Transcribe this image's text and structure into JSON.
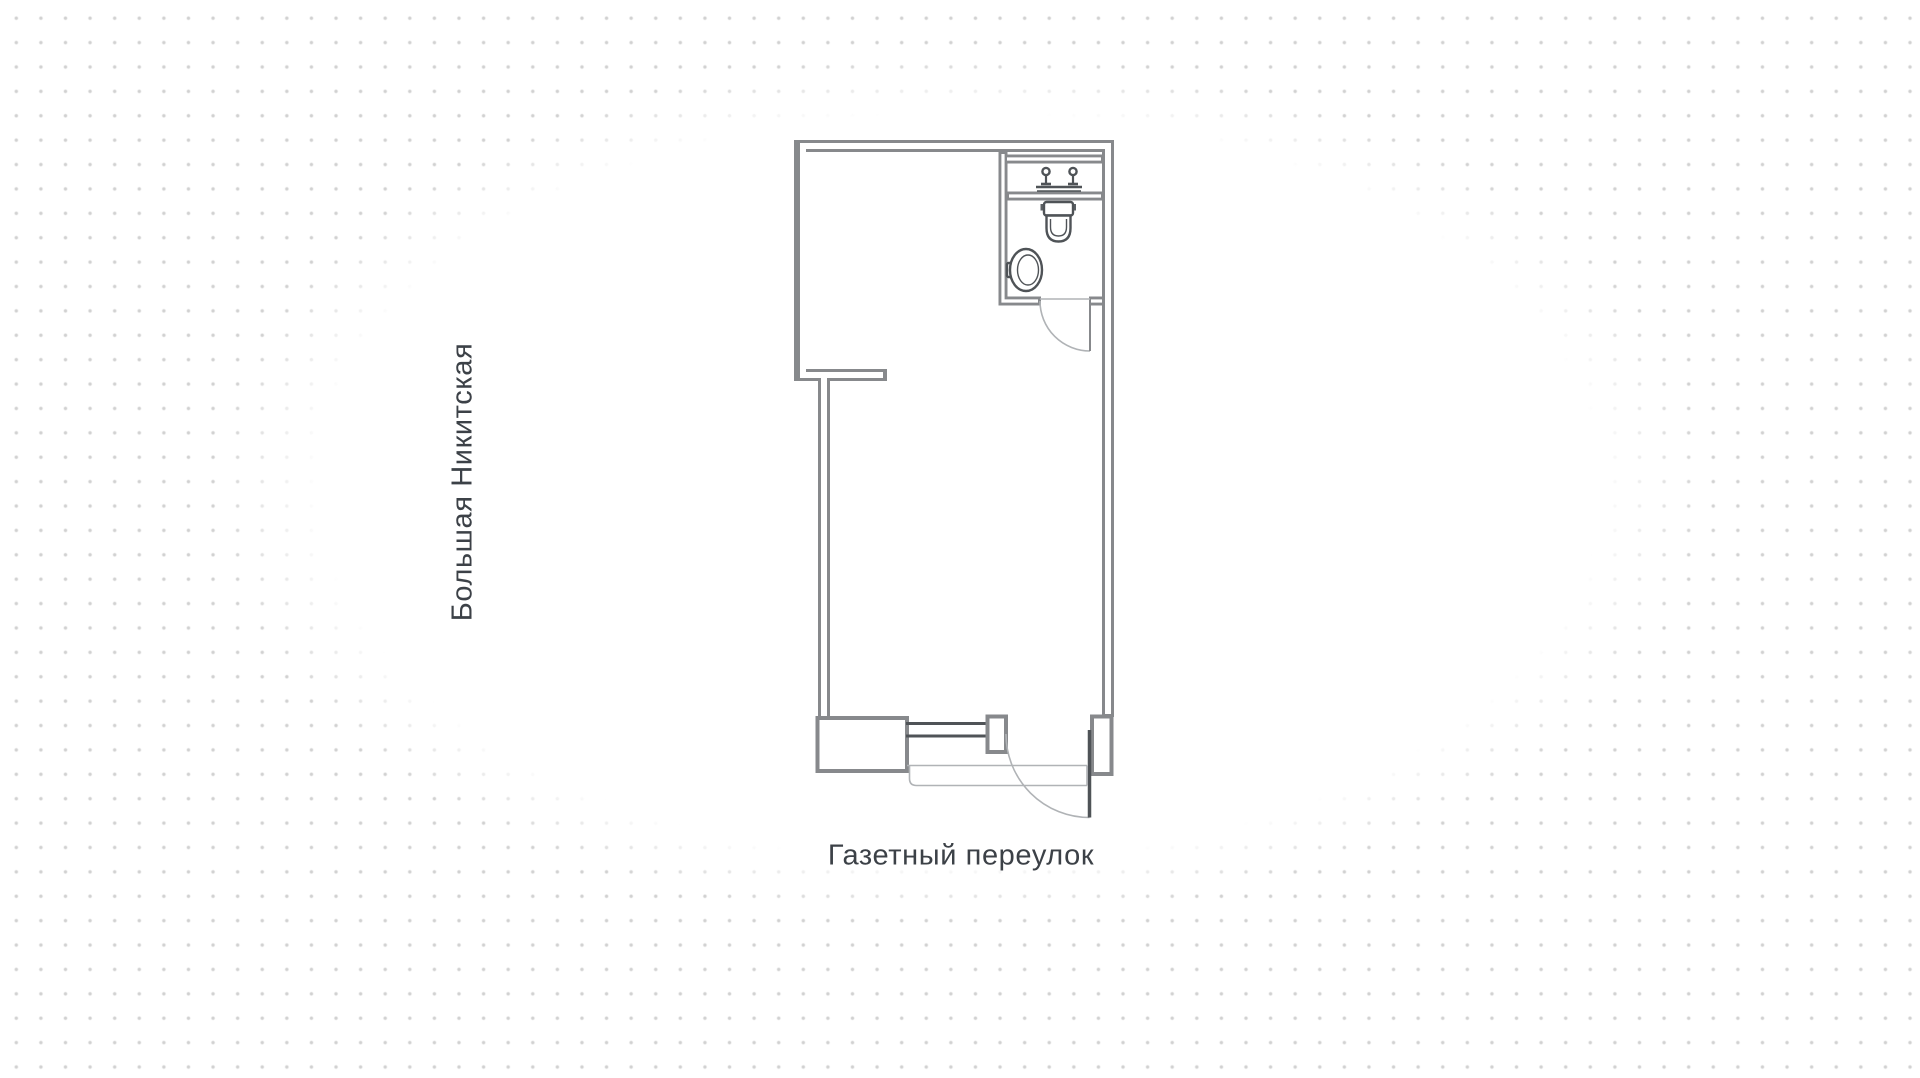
{
  "plan": {
    "street_left": "Большая Никитская",
    "street_bottom": "Газетный переулок",
    "rooms": {
      "bathroom_fixtures": [
        "faucet",
        "toilet",
        "washbasin"
      ],
      "entrance": {
        "side": "bottom",
        "elements": [
          "window",
          "door"
        ]
      },
      "bathroom_door_side": "bottom-of-bathroom"
    }
  },
  "colors": {
    "wall": "#87898c",
    "joinery": "#4f5357",
    "thin": "#b0b3b6",
    "text": "#3c4147",
    "dot": "#d1d1d1"
  }
}
